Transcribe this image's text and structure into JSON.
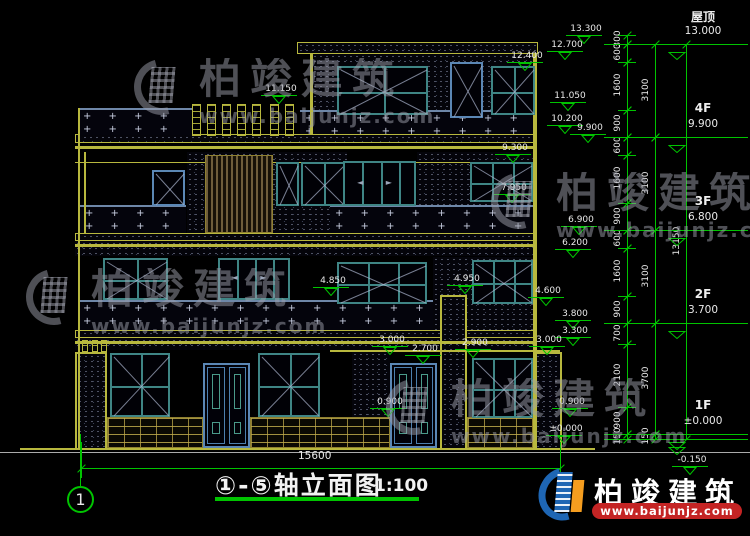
{
  "title": {
    "text": "①-⑤轴立面图",
    "scale": "1:100"
  },
  "axis_bubble": {
    "label": "1"
  },
  "bottom_dim": {
    "label": "15600",
    "text_x": 298,
    "text_y": 450,
    "line_y": 468,
    "x1": 81,
    "x2": 560
  },
  "brand": {
    "name": "柏竣建筑",
    "url": "www.baijunjz.com"
  },
  "colors": {
    "cad_yellow": "#b8b83e",
    "cad_green": "#00c400",
    "window_teal": "#3f8585",
    "window_blue": "#5b87b5",
    "logo_blue": "#1e66b4",
    "logo_orange": "#f59d1f",
    "brand_red": "#c42424"
  },
  "floor_labels": [
    {
      "name": "屋顶",
      "value": "13.000",
      "y": 44
    },
    {
      "name": "4F",
      "value": "9.900",
      "y": 137
    },
    {
      "name": "3F",
      "value": "6.800",
      "y": 230
    },
    {
      "name": "2F",
      "value": "3.700",
      "y": 323
    },
    {
      "name": "1F",
      "value": "±0.000",
      "y": 434
    },
    {
      "name": "",
      "value": "-0.150",
      "y": 439
    }
  ],
  "elev_markers": [
    {
      "label": "13.300",
      "x": 566,
      "y": 24
    },
    {
      "label": "12.700",
      "x": 547,
      "y": 40
    },
    {
      "label": "12.400",
      "x": 507,
      "y": 51
    },
    {
      "label": "11.150",
      "x": 261,
      "y": 84
    },
    {
      "label": "11.050",
      "x": 550,
      "y": 91
    },
    {
      "label": "10.200",
      "x": 547,
      "y": 114
    },
    {
      "label": "9.900",
      "x": 570,
      "y": 123
    },
    {
      "label": "9.300",
      "x": 495,
      "y": 143
    },
    {
      "label": "7.950",
      "x": 494,
      "y": 183
    },
    {
      "label": "6.900",
      "x": 561,
      "y": 215
    },
    {
      "label": "6.200",
      "x": 555,
      "y": 238
    },
    {
      "label": "4.950",
      "x": 447,
      "y": 274
    },
    {
      "label": "4.850",
      "x": 313,
      "y": 276
    },
    {
      "label": "4.600",
      "x": 528,
      "y": 286
    },
    {
      "label": "3.800",
      "x": 555,
      "y": 309
    },
    {
      "label": "3.300",
      "x": 555,
      "y": 326
    },
    {
      "label": "3.000",
      "x": 372,
      "y": 335
    },
    {
      "label": "3.000",
      "x": 529,
      "y": 335
    },
    {
      "label": "2.900",
      "x": 455,
      "y": 338
    },
    {
      "label": "2.700",
      "x": 405,
      "y": 344
    },
    {
      "label": "0.900",
      "x": 370,
      "y": 397
    },
    {
      "label": "0.900",
      "x": 552,
      "y": 397
    },
    {
      "label": "±0.000",
      "x": 546,
      "y": 424
    },
    {
      "label": "-0.150",
      "x": 672,
      "y": 455
    }
  ],
  "dim_chains": [
    {
      "x": 627,
      "segments": [
        [
          35,
          44,
          "300"
        ],
        [
          44,
          62,
          "600"
        ],
        [
          62,
          110,
          "1600"
        ],
        [
          110,
          137,
          "900"
        ],
        [
          137,
          155,
          "600"
        ],
        [
          155,
          203,
          "1600"
        ],
        [
          203,
          230,
          "900"
        ],
        [
          230,
          248,
          "600"
        ],
        [
          248,
          296,
          "1600"
        ],
        [
          296,
          323,
          "900"
        ],
        [
          323,
          344,
          "700"
        ],
        [
          344,
          407,
          "2100"
        ],
        [
          407,
          434,
          "900"
        ],
        [
          434,
          439,
          "150"
        ]
      ]
    },
    {
      "x": 655,
      "segments": [
        [
          44,
          137,
          "3100"
        ],
        [
          137,
          230,
          "3100"
        ],
        [
          230,
          323,
          "3100"
        ],
        [
          323,
          434,
          "3700"
        ],
        [
          434,
          439,
          "150"
        ]
      ]
    },
    {
      "x": 686,
      "segments": [
        [
          44,
          439,
          "13150"
        ]
      ]
    }
  ],
  "drawing": {
    "stipple": [
      {
        "x": 297,
        "y": 42,
        "w": 241,
        "h": 12,
        "frame": 1
      },
      {
        "x": 312,
        "y": 54,
        "w": 223,
        "h": 58
      },
      {
        "x": 75,
        "y": 134,
        "w": 462,
        "h": 9,
        "frame": 1
      },
      {
        "x": 187,
        "y": 152,
        "w": 160,
        "h": 81
      },
      {
        "x": 417,
        "y": 152,
        "w": 120,
        "h": 53
      },
      {
        "x": 75,
        "y": 233,
        "w": 462,
        "h": 8,
        "frame": 1
      },
      {
        "x": 75,
        "y": 241,
        "w": 462,
        "h": 15
      },
      {
        "x": 433,
        "y": 257,
        "w": 104,
        "h": 73
      },
      {
        "x": 75,
        "y": 330,
        "w": 462,
        "h": 8,
        "frame": 1
      },
      {
        "x": 75,
        "y": 338,
        "w": 462,
        "h": 12
      },
      {
        "x": 352,
        "y": 352,
        "w": 38,
        "h": 96
      }
    ],
    "piers": [
      {
        "x": 75,
        "y": 352,
        "w": 32,
        "h": 96
      },
      {
        "x": 440,
        "y": 295,
        "w": 27,
        "h": 153
      },
      {
        "x": 533,
        "y": 352,
        "w": 29,
        "h": 96
      }
    ],
    "plus_bands": [
      {
        "x": 78,
        "y": 108,
        "w": 114,
        "h": 27
      },
      {
        "x": 300,
        "y": 110,
        "w": 237,
        "h": 24
      },
      {
        "x": 80,
        "y": 205,
        "w": 106,
        "h": 28
      },
      {
        "x": 330,
        "y": 205,
        "w": 207,
        "h": 28
      },
      {
        "x": 78,
        "y": 300,
        "w": 355,
        "h": 30
      }
    ],
    "ylines": [
      {
        "x": 78,
        "y": 108,
        "w": 2,
        "h": 340
      },
      {
        "x": 533,
        "y": 54,
        "w": 4,
        "h": 394
      },
      {
        "x": 310,
        "y": 54,
        "w": 3,
        "h": 80
      },
      {
        "x": 84,
        "y": 152,
        "w": 2,
        "h": 81
      },
      {
        "x": 75,
        "y": 146,
        "w": 462,
        "h": 3
      },
      {
        "x": 75,
        "y": 162,
        "w": 462,
        "h": 1
      },
      {
        "x": 75,
        "y": 244,
        "w": 462,
        "h": 3
      },
      {
        "x": 75,
        "y": 341,
        "w": 462,
        "h": 3
      },
      {
        "x": 330,
        "y": 350,
        "w": 230,
        "h": 2
      },
      {
        "x": 20,
        "y": 448,
        "w": 575,
        "h": 2
      }
    ],
    "louver": {
      "x": 205,
      "y": 155,
      "w": 68,
      "h": 78
    },
    "bricks": [
      {
        "x": 107,
        "y": 417,
        "w": 96,
        "h": 31
      },
      {
        "x": 250,
        "y": 417,
        "w": 140,
        "h": 31
      },
      {
        "x": 467,
        "y": 417,
        "w": 66,
        "h": 31
      }
    ],
    "posts": [
      {
        "x": 192,
        "y": 104,
        "w": 9,
        "h": 32
      },
      {
        "x": 207,
        "y": 104,
        "w": 9,
        "h": 32
      },
      {
        "x": 222,
        "y": 104,
        "w": 9,
        "h": 32
      },
      {
        "x": 237,
        "y": 104,
        "w": 9,
        "h": 32
      },
      {
        "x": 252,
        "y": 104,
        "w": 9,
        "h": 32
      },
      {
        "x": 270,
        "y": 104,
        "w": 9,
        "h": 32
      },
      {
        "x": 285,
        "y": 104,
        "w": 9,
        "h": 32
      },
      {
        "x": 82,
        "y": 340,
        "w": 6,
        "h": 12
      },
      {
        "x": 92,
        "y": 340,
        "w": 6,
        "h": 12
      },
      {
        "x": 101,
        "y": 340,
        "w": 6,
        "h": 12
      }
    ],
    "windows": [
      {
        "x": 337,
        "y": 66,
        "w": 91,
        "h": 49,
        "c": 2,
        "r": 2,
        "diag": 1
      },
      {
        "x": 450,
        "y": 62,
        "w": 33,
        "h": 56,
        "c": 1,
        "r": 1,
        "diag": 1,
        "blue": 1
      },
      {
        "x": 491,
        "y": 66,
        "w": 44,
        "h": 49,
        "c": 2,
        "r": 2,
        "diag": 1
      },
      {
        "x": 152,
        "y": 170,
        "w": 33,
        "h": 36,
        "c": 1,
        "r": 1,
        "diag": 1,
        "blue": 1
      },
      {
        "x": 276,
        "y": 162,
        "w": 23,
        "h": 44,
        "c": 1,
        "r": 1,
        "diag": 1
      },
      {
        "x": 301,
        "y": 162,
        "w": 44,
        "h": 44,
        "c": 2,
        "r": 1,
        "diag": 1
      },
      {
        "x": 343,
        "y": 161,
        "w": 73,
        "h": 45,
        "c": 4,
        "r": 1,
        "slider": 1
      },
      {
        "x": 470,
        "y": 162,
        "w": 63,
        "h": 40,
        "c": 3,
        "r": 2,
        "diag": 1
      },
      {
        "x": 103,
        "y": 258,
        "w": 65,
        "h": 42,
        "c": 2,
        "r": 2,
        "diag": 1
      },
      {
        "x": 218,
        "y": 258,
        "w": 72,
        "h": 42,
        "c": 4,
        "r": 1,
        "slider": 1
      },
      {
        "x": 337,
        "y": 262,
        "w": 90,
        "h": 42,
        "c": 3,
        "r": 2,
        "diag": 1
      },
      {
        "x": 472,
        "y": 260,
        "w": 61,
        "h": 44,
        "c": 3,
        "r": 2,
        "diag": 1
      },
      {
        "x": 110,
        "y": 353,
        "w": 60,
        "h": 64,
        "c": 2,
        "r": 2,
        "diag": 1
      },
      {
        "x": 258,
        "y": 353,
        "w": 62,
        "h": 64,
        "c": 2,
        "r": 2,
        "diag": 1
      },
      {
        "x": 472,
        "y": 358,
        "w": 61,
        "h": 60,
        "c": 3,
        "r": 2,
        "diag": 1
      }
    ],
    "doors": [
      {
        "x": 203,
        "y": 363,
        "w": 47,
        "h": 85
      },
      {
        "x": 390,
        "y": 363,
        "w": 47,
        "h": 85
      }
    ],
    "ground2": {
      "x": 0,
      "y": 452,
      "w": 750,
      "h": 1
    }
  },
  "watermarks": [
    {
      "x": 133,
      "y": 58,
      "clip_w": 480
    },
    {
      "x": 490,
      "y": 172,
      "clip_w": 260
    },
    {
      "x": 25,
      "y": 268,
      "clip_w": 270
    },
    {
      "x": 385,
      "y": 378,
      "clip_w": 245
    }
  ],
  "floor_line": {
    "x1": 604,
    "x2": 748,
    "tri_x": 668
  },
  "axis_line": {
    "x": 80,
    "y1": 434,
    "y2": 486,
    "cx": 67,
    "cy": 486,
    "d": 27
  }
}
